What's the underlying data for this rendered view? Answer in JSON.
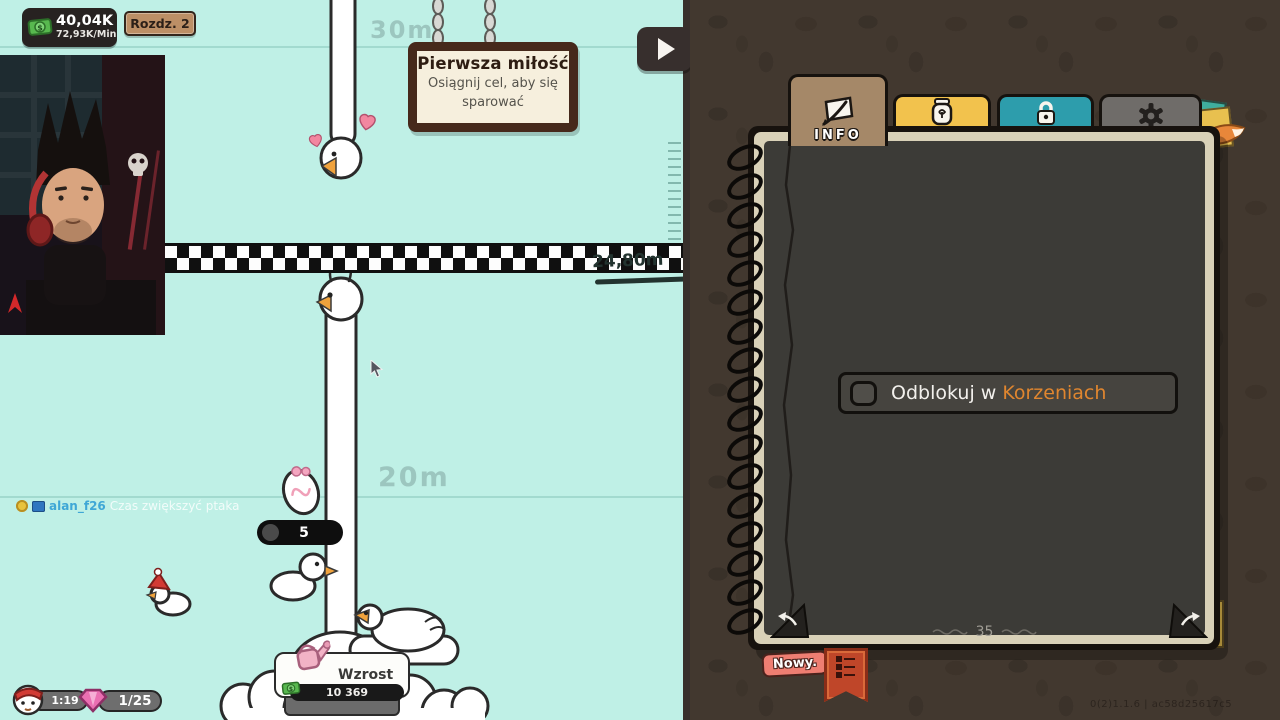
{
  "game": {
    "hud": {
      "money": "40,04K",
      "money_rate": "72,93K/Min",
      "chapter_badge": "Rozdz. 2",
      "timer": "1:19",
      "gem_count": "1/25",
      "neck_counter": "5"
    },
    "growth_button": {
      "label": "Wzrost",
      "cost": "10 369"
    },
    "sign": {
      "title": "Pierwsza miłość",
      "line1": "Osiągnij cel, aby się",
      "line2": "sparować"
    },
    "markers": {
      "top": "30m",
      "middle": "20m",
      "height_line": "24,80m"
    },
    "chat": {
      "username": "alan_f26",
      "message": "Czas zwiększyć ptaka"
    }
  },
  "panel": {
    "tabs": [
      {
        "label": "INFO",
        "icon": "quill-paper-icon",
        "color": "#a58868",
        "active": true
      },
      {
        "label": "DNA",
        "icon": "jar-icon",
        "color": "#f2c24d",
        "active": false
      },
      {
        "label": "ODBLOKUJ",
        "icon": "padlock-icon",
        "color": "#2d9dac",
        "active": false
      },
      {
        "label": "KONFIGURACJA",
        "icon": "gear-icon",
        "color": "#6f6c69",
        "active": false
      }
    ],
    "unlock_row": {
      "text": "Odblokuj w ",
      "highlight": "Korzeniach",
      "highlight_color": "#e0862f"
    },
    "page_number": "35",
    "new_badge": "Nowy.",
    "version": "0(2)1.1.6 | ac58d25617c5"
  },
  "colors": {
    "game_background": "#bff0e6",
    "panel_background": "#42382f",
    "accent_orange": "#e0862f",
    "tab_dna_yellow": "#f2c24d",
    "tab_unlock_teal": "#2d9dac"
  }
}
